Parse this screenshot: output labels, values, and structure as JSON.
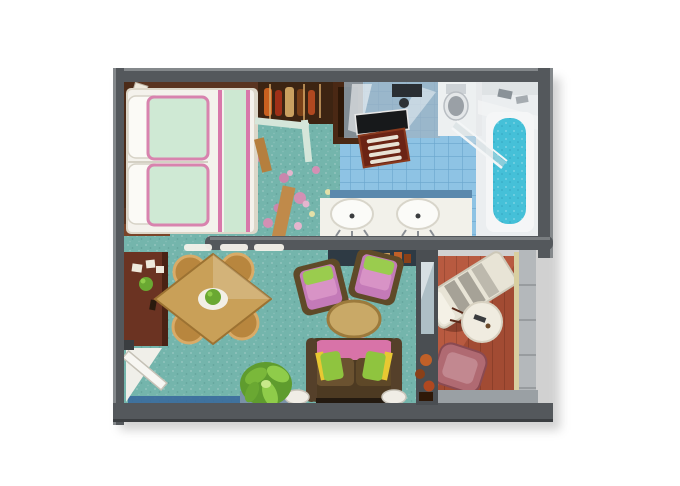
{
  "meta": {
    "type": "floor-plan-illustration",
    "subject": "cruise-suite-floor-plan",
    "background": "#ffffff",
    "rooms_count": 4
  },
  "palette": {
    "wall": "#54585c",
    "wall_highlight": "#84888b",
    "carpet": "#74b5ac",
    "tile": "#8ec3e4",
    "tile_grid": "#69a5cc",
    "deck": "#a24b33",
    "deck_light": "#b85a40",
    "tub": "#45c0d8",
    "bed_white": "#f4f2ec",
    "bed_green": "#cde8d2",
    "trim_pink": "#d878aa",
    "sofa_brown": "#4d3a22",
    "pillow_green": "#8fc43f",
    "pillow_yellow": "#e8c832",
    "armchair_purple": "#c47ab8",
    "wood_dark": "#5a3420",
    "sideboard_red": "#6b3322",
    "dining_wood": "#c9a058",
    "railing_gray": "#b4b8bb",
    "flower_pink": "#d98fb5"
  },
  "rooms": {
    "bedroom": {
      "name": "bedroom",
      "floor": "teal carpet with pink flower pattern",
      "items": [
        "double-bed",
        "white-pillows",
        "green-pillows",
        "headboard-console",
        "nightstand",
        "wardrobe-closet",
        "hanging-clothes",
        "closet-partition"
      ]
    },
    "bathroom": {
      "name": "bathroom",
      "floor": "blue tile",
      "items": [
        "shower",
        "toilet",
        "double-sink-vanity",
        "wood-bath-mat",
        "dark-counter",
        "bathtub",
        "glass-partition",
        "shelf"
      ]
    },
    "living_room": {
      "name": "living-dining-room",
      "floor": "teal carpet with pink flower pattern",
      "items": [
        "sideboard",
        "entry-door",
        "dining-table",
        "dining-chair-1",
        "dining-chair-2",
        "dining-chair-3",
        "dining-chair-4",
        "armchair-1",
        "armchair-2",
        "coffee-table",
        "sofa",
        "throw-pillows",
        "potted-plant",
        "side-lamp-left",
        "side-lamp-right",
        "wall-console",
        "window-sill"
      ]
    },
    "balcony": {
      "name": "balcony",
      "floor": "hardwood deck",
      "items": [
        "sun-lounger",
        "round-table",
        "deck-chair",
        "railing",
        "sliding-glass-door",
        "planter"
      ]
    }
  },
  "counts": {
    "dining_chairs": 4,
    "armchairs": 2,
    "sinks": 2,
    "loungers": 1
  }
}
